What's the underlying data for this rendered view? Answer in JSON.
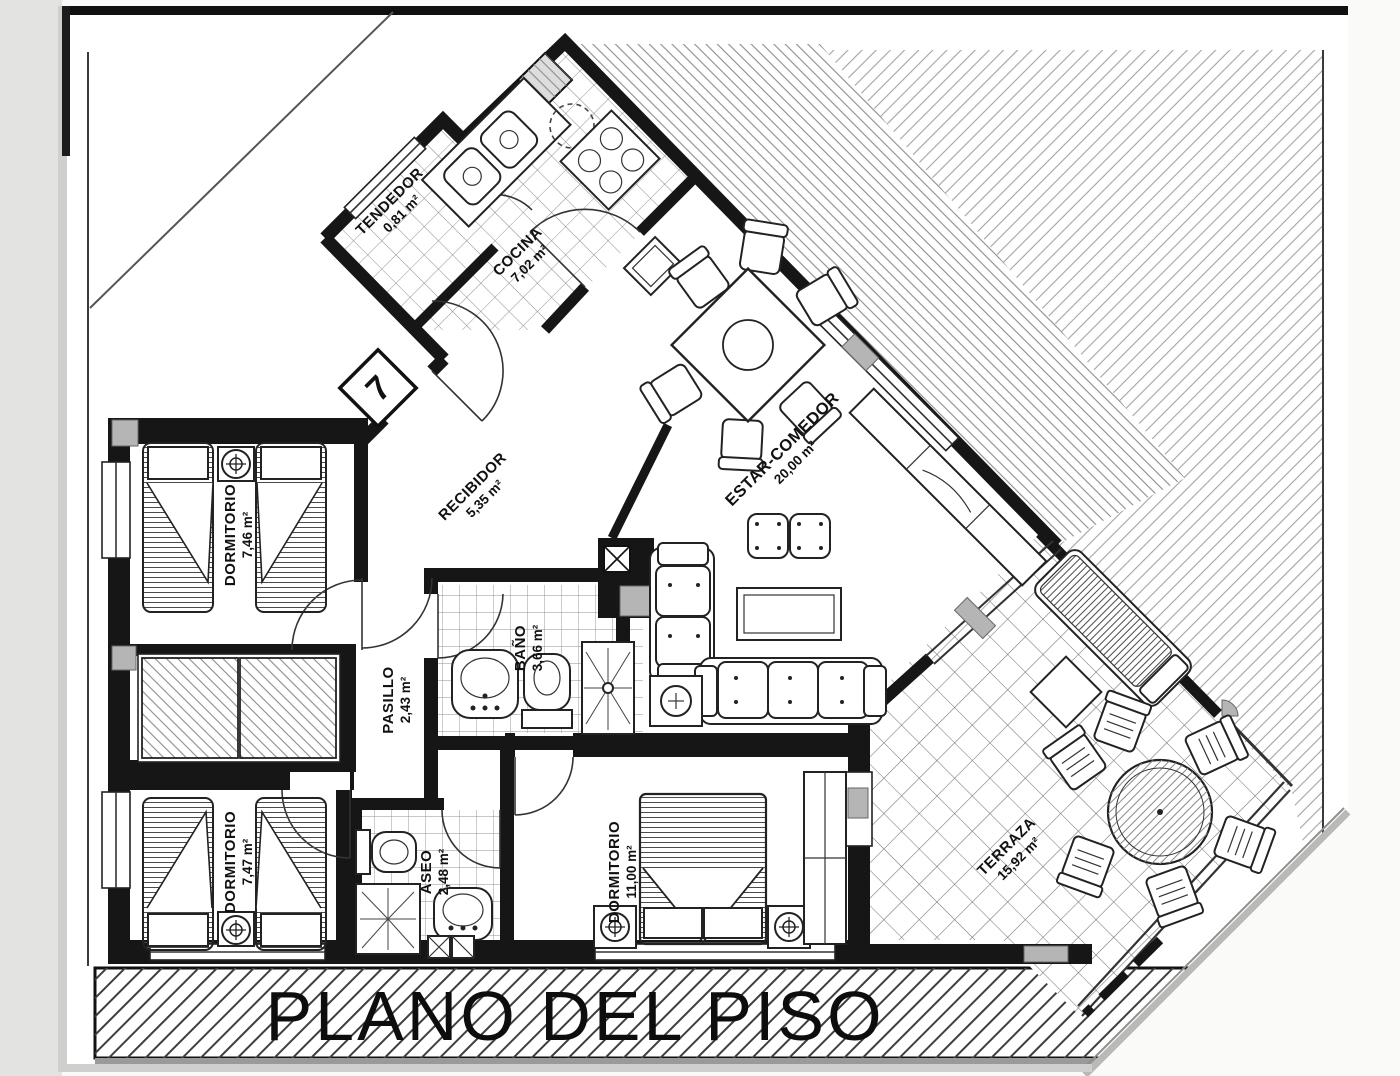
{
  "document": {
    "title": "PLANO DEL PISO",
    "apartment_number": "7"
  },
  "rooms": [
    {
      "name": "TENDEDOR",
      "area": "0,81 m²"
    },
    {
      "name": "COCINA",
      "area": "7,02 m²"
    },
    {
      "name": "ESTAR-COMEDOR",
      "area": "20,00 m²"
    },
    {
      "name": "RECIBIDOR",
      "area": "5,35 m²"
    },
    {
      "name": "DORMITORIO",
      "area": "7,46 m²"
    },
    {
      "name": "PASILLO",
      "area": "2,43 m²"
    },
    {
      "name": "BAÑO",
      "area": "3,66 m²"
    },
    {
      "name": "DORMITORIO",
      "area": "7,47 m²"
    },
    {
      "name": "ASEO",
      "area": "2,48 m²"
    },
    {
      "name": "DORMITORIO",
      "area": "11,00 m²"
    },
    {
      "name": "TERRAZA",
      "area": "15,92 m²"
    }
  ],
  "colors": {
    "ink": "#161616",
    "paper": "#ffffff",
    "hatch_light": "#a3a3a3",
    "slider_gray": "#b5b5b5"
  }
}
